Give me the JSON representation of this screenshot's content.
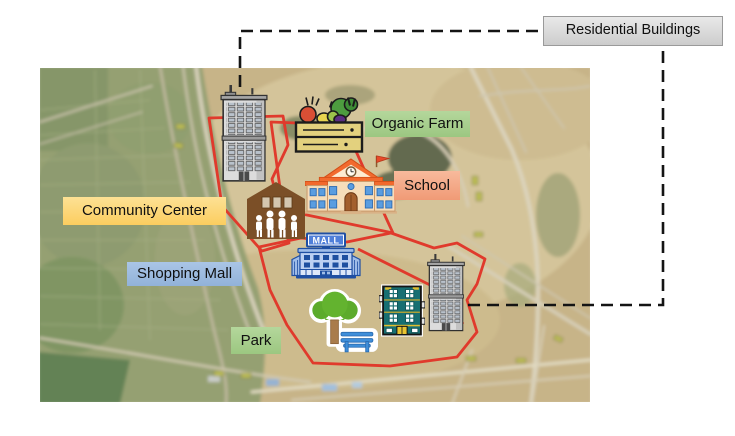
{
  "callout": {
    "label": "Residential Buildings"
  },
  "zone_labels": {
    "organic_farm": "Organic Farm",
    "school": "School",
    "community_center": "Community Center",
    "shopping_mall": "Shopping Mall",
    "park": "Park"
  },
  "mall_icon": {
    "sign_text": "MALL"
  },
  "icons": [
    "residential-tower-icon",
    "organic-farm-crate-icon",
    "school-building-icon",
    "community-center-icon",
    "shopping-mall-icon",
    "park-tree-bench-icon",
    "apartment-block-icon"
  ],
  "colors": {
    "zone_outline": "#e03a2c",
    "connector_line": "#141414",
    "label_organic_farm": "#a9d18e",
    "label_school": "#f4a583",
    "label_community_center": "#fcd36a",
    "label_shopping_mall": "#9dc3e6",
    "label_park": "#a9d18e",
    "label_residential_buildings": "#d9d9d9"
  }
}
